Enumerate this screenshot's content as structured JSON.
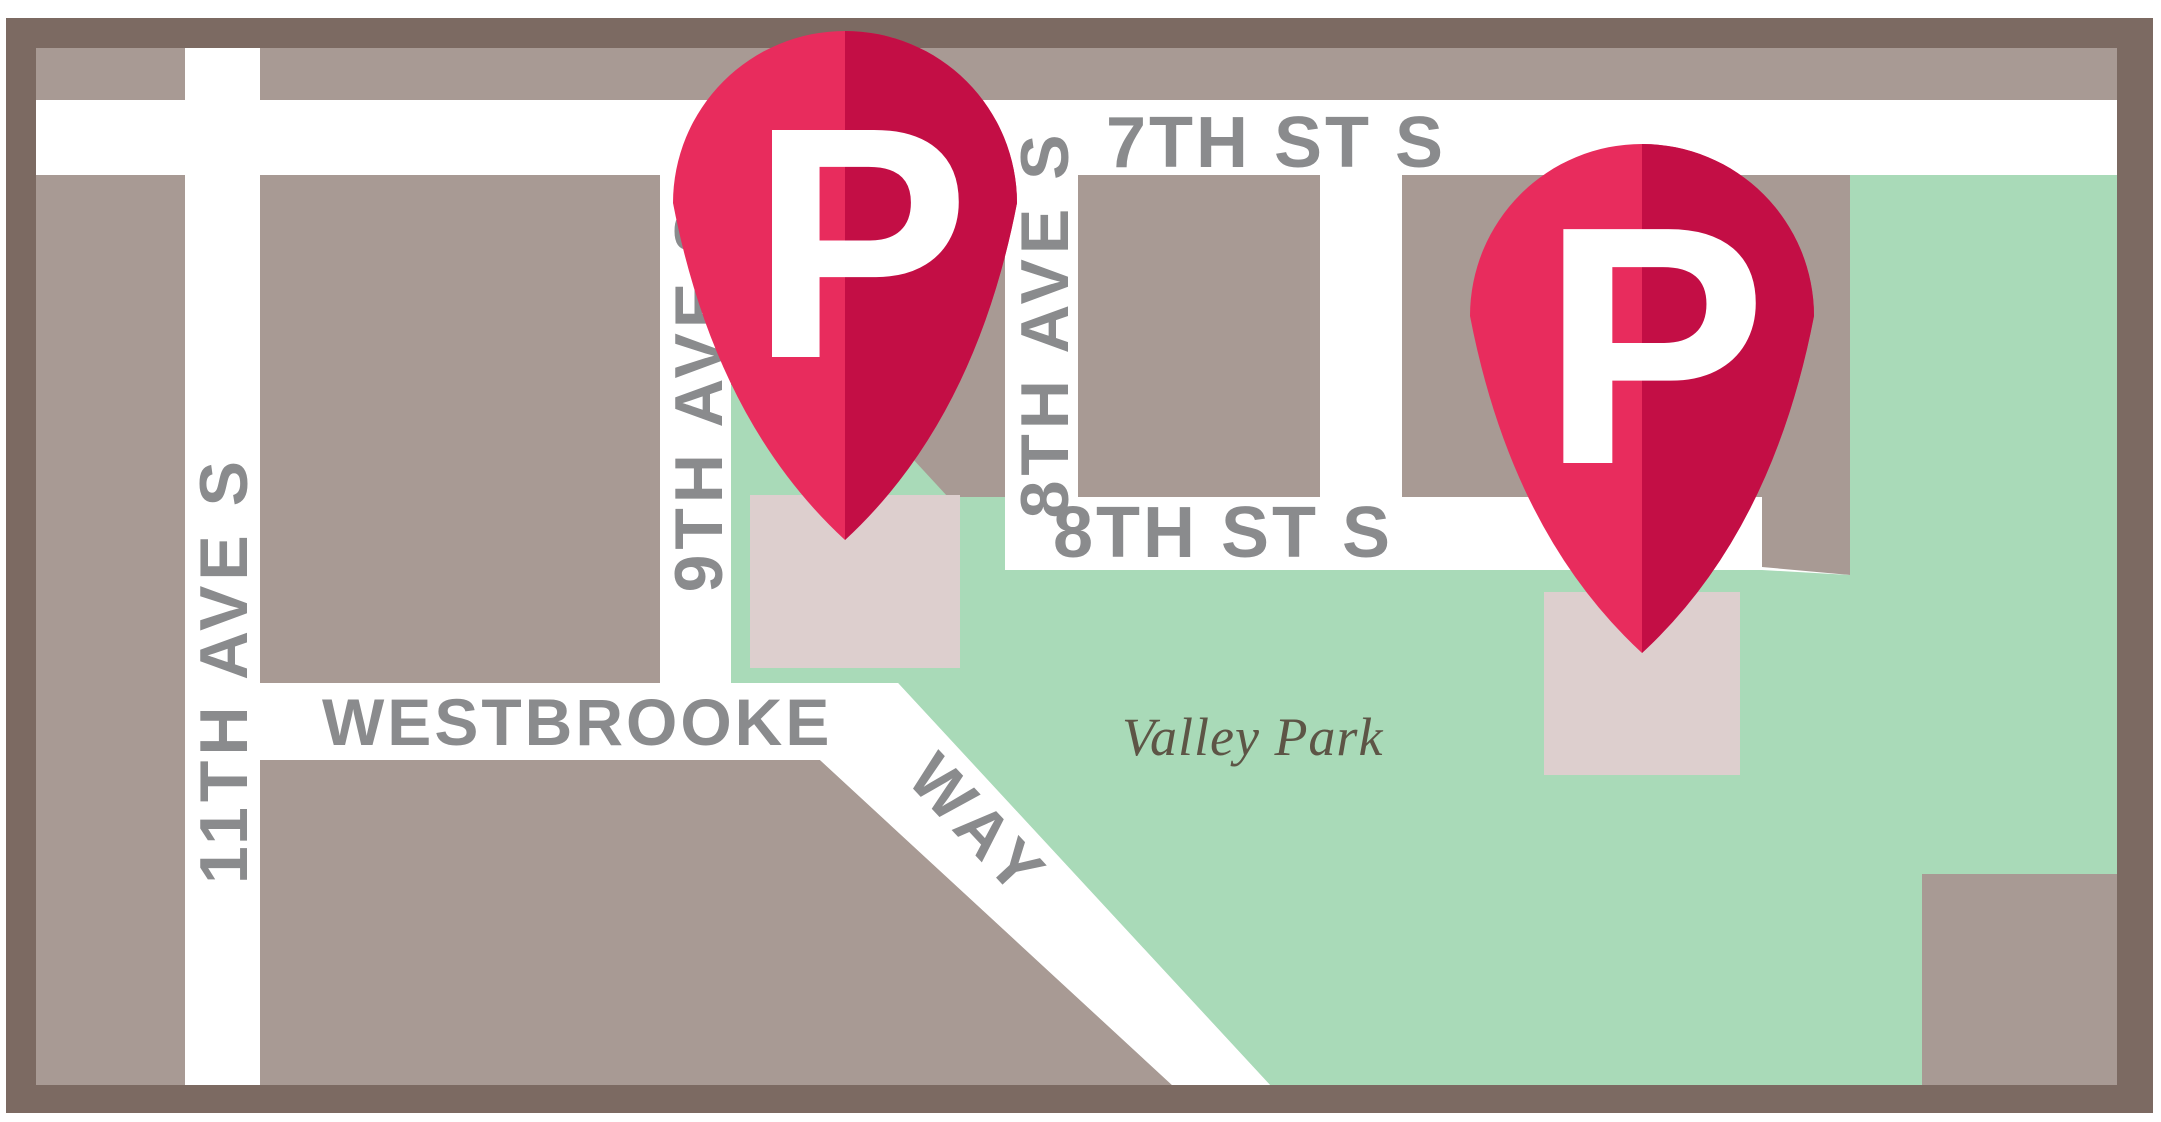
{
  "colors": {
    "frame": "#7c6a62",
    "road": "#ffffff",
    "block": "#a89a94",
    "park": "#a9dab8",
    "parking_lot": "#ddcfce",
    "pin_light": "#e82c5d",
    "pin_dark": "#c30e45",
    "pin_letter": "#ffffff",
    "street_label": "#8a8b8d",
    "park_label": "#5d5546"
  },
  "map": {
    "streets": {
      "seventh_st": "7TH ST S",
      "eighth_st": "8TH ST S",
      "eighth_ave": "8TH AVE S",
      "ninth_ave": "9TH AVE S",
      "eleventh_ave": "11TH AVE S",
      "westbrooke": "WESTBROOKE",
      "way": "WAY"
    },
    "park_label": "Valley Park",
    "pins": [
      {
        "label": "P"
      },
      {
        "label": "P"
      }
    ]
  }
}
